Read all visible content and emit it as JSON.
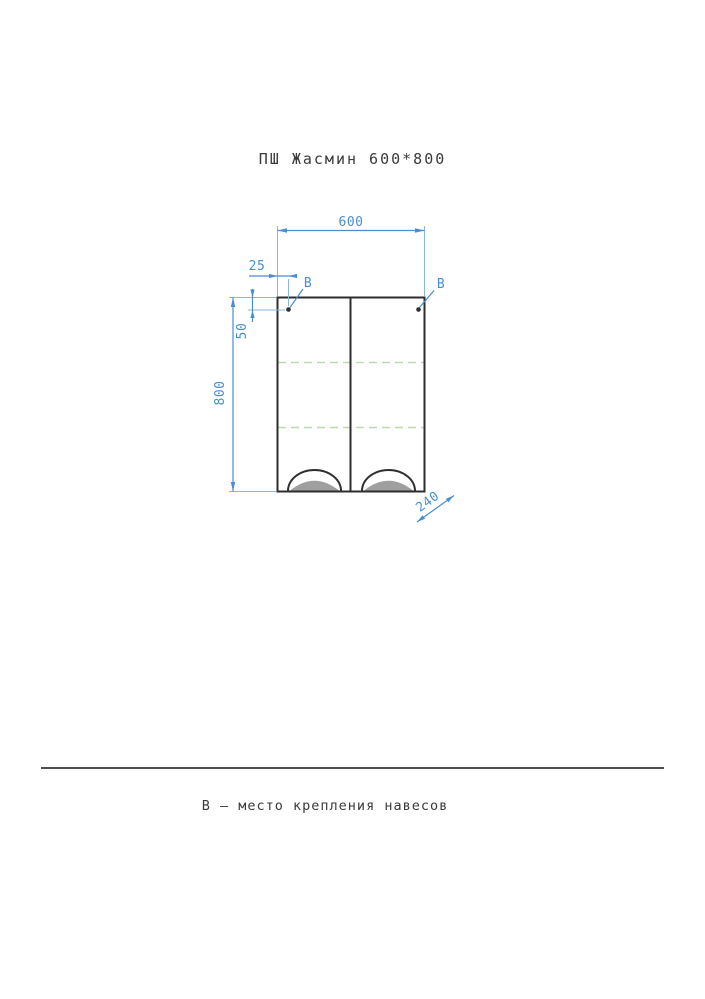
{
  "title": "ПШ Жасмин 600*800",
  "caption": "В – место крепления навесов",
  "colors": {
    "line": "#2e2e2e",
    "dimension": "#4a8ed0",
    "extension": "#8ab6e2",
    "shelf": "#b9dcae",
    "handle": "#9f9f9f",
    "separator": "#4f4f4f",
    "text": "#3a3a3a"
  },
  "drawing": {
    "type": "technical-front-view",
    "cabinet": {
      "name": "ПШ Жасмин",
      "width_mm": 600,
      "height_mm": 800,
      "depth_mm": 240,
      "doors": 2,
      "shelves": 2,
      "mount_offset_x_mm": 25,
      "mount_offset_y_mm": 50
    },
    "dimensions": {
      "width": "600",
      "mount_offset_x": "25",
      "mount_offset_y": "50",
      "height": "800",
      "depth": "240"
    },
    "markers": {
      "left": "В",
      "right": "В"
    }
  }
}
